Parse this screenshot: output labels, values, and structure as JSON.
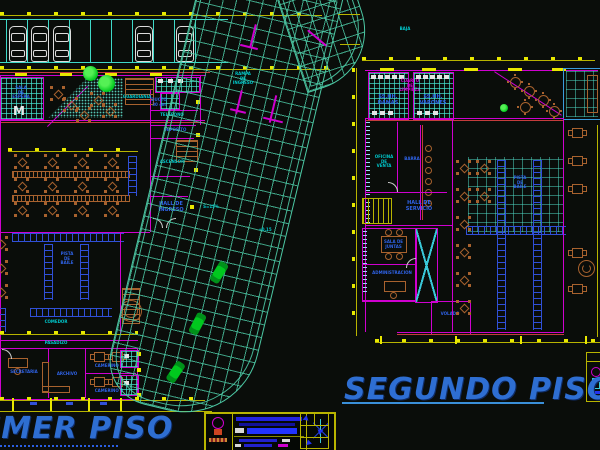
{
  "floors": {
    "first": {
      "title": "PRIMER PISO",
      "labels": {
        "sala_espera": "SALA\nDE\nESPERA",
        "guardiania": "GUARDIANIA",
        "ducto": "DUCTO\n30 cm",
        "telefono": "TELEFONO",
        "deposito": "DEPOSITO",
        "ascensor": "ASCENSOR",
        "hall_ingreso": "HALL DE\nINGRESO",
        "pista_baile": "PISTA\nDE\nBAILE",
        "comedor": "COMEDOR",
        "pasadizo": "PASADIZO",
        "secretaria": "SECRETARIA",
        "archivo": "ARCHIVO",
        "camerino_a": "CAMERINO A",
        "camerino_b": "CAMERINO B"
      }
    },
    "second": {
      "title": "SEGUNDO PISO",
      "labels": {
        "sshh_damas": "SS.HH.\nDAMAS",
        "sshh_varones": "SS.HH.\nVARONES",
        "cuarto_limpieza": "CUARTO\nDE\nLIMPIEZA",
        "oficina_venta": "OFICINA\nDE\nVENTA",
        "barra": "BARRA",
        "hall_servicio": "HALL DE\nSERVICIO",
        "pista_baile": "PISTA\nDE\nBAILE",
        "sala_juntas": "SALA DE\nJUNTAS",
        "administracion": "ADMINISTRACION",
        "volado": "VOLADO"
      }
    }
  },
  "ramp_labels": {
    "main": "RAMPA\nDE\nINGRESO",
    "slope": "S=15%",
    "nivel": "+0.15",
    "baja": "BAJA"
  },
  "colors": {
    "background": "#0a0d0a",
    "walls_magenta": "#cf00cf",
    "dimension_yellow": "#e8e800",
    "ramp_mesh_teal": "#4cc8a4",
    "furniture_brown": "#a8622e",
    "labels_blue": "#2f63e8",
    "labels_cyan": "#00c8cc",
    "floor_titles_blue": "#2e6ed2",
    "accent_red": "#c43c3c",
    "furniture_blue": "#3050d8",
    "vegetation_green": "#00c81e",
    "cars_white": "#dcdcdc"
  }
}
